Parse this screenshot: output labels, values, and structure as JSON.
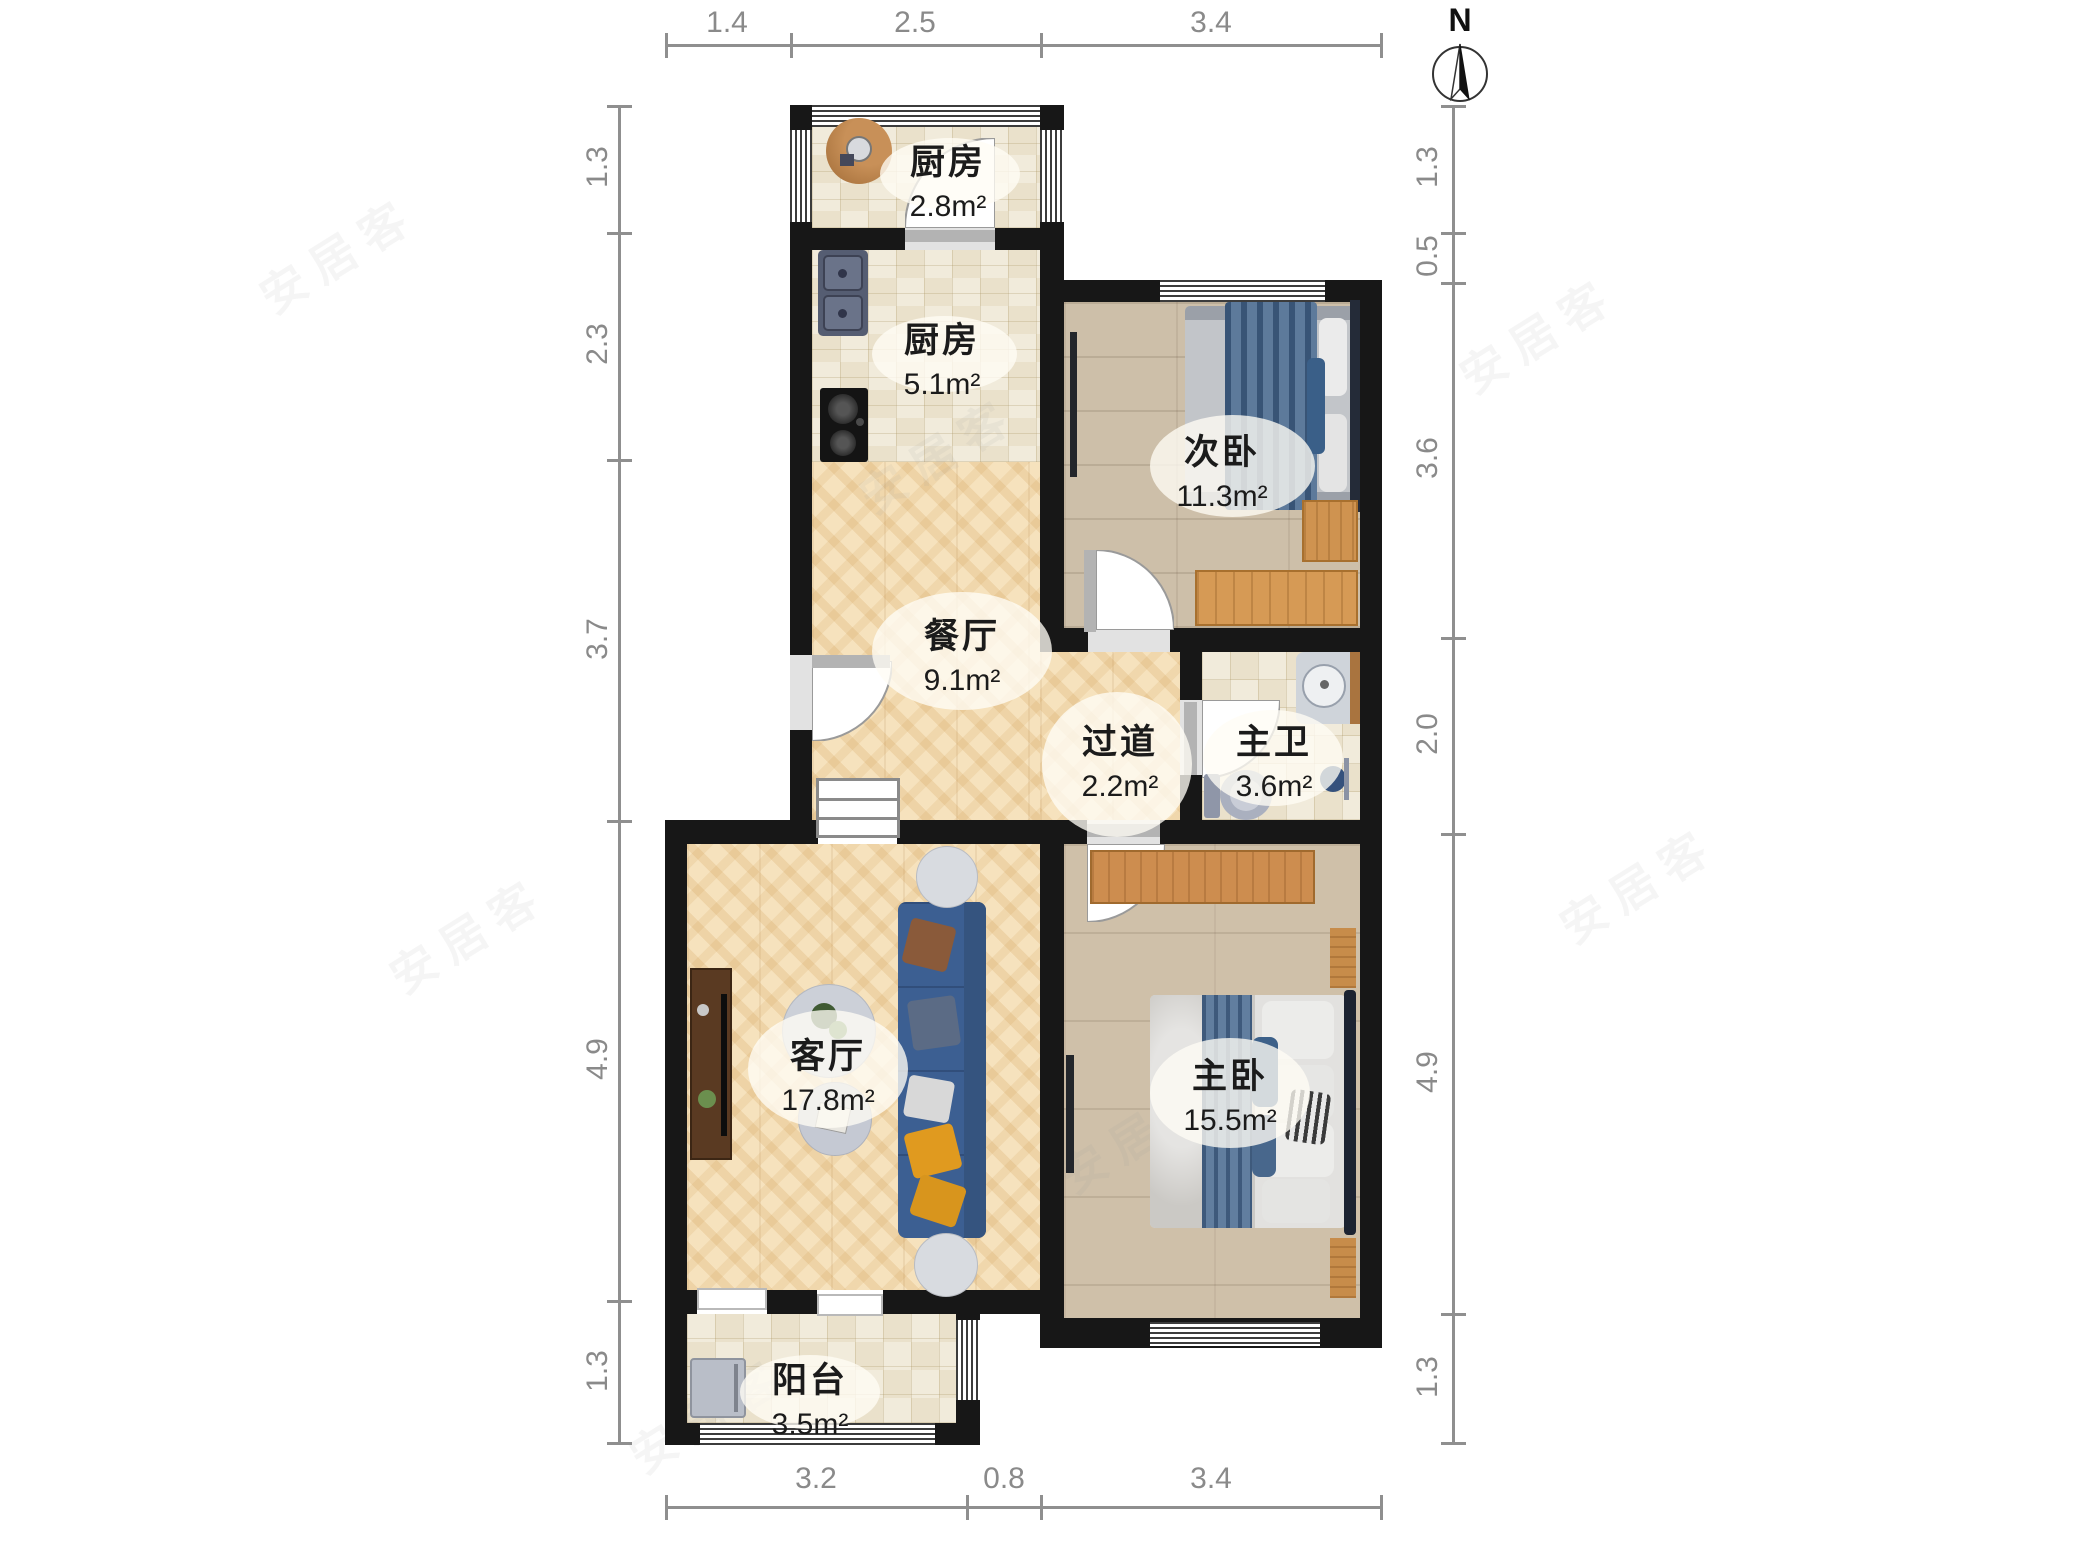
{
  "compass": {
    "label": "N"
  },
  "watermark": {
    "text": "安居客"
  },
  "dimensions": {
    "top": [
      "1.4",
      "2.5",
      "3.4"
    ],
    "bottom": [
      "3.2",
      "0.8",
      "3.4"
    ],
    "left": [
      "1.3",
      "2.3",
      "3.7",
      "4.9",
      "1.3"
    ],
    "right": [
      "1.3",
      "0.5",
      "3.6",
      "2.0",
      "4.9",
      "1.3"
    ]
  },
  "rooms": [
    {
      "id": "kitchen-balcony",
      "name": "厨房",
      "area": "2.8m²"
    },
    {
      "id": "kitchen",
      "name": "厨房",
      "area": "5.1m²"
    },
    {
      "id": "second-bedroom",
      "name": "次卧",
      "area": "11.3m²"
    },
    {
      "id": "dining-room",
      "name": "餐厅",
      "area": "9.1m²"
    },
    {
      "id": "hallway",
      "name": "过道",
      "area": "2.2m²"
    },
    {
      "id": "master-bathroom",
      "name": "主卫",
      "area": "3.6m²"
    },
    {
      "id": "living-room",
      "name": "客厅",
      "area": "17.8m²"
    },
    {
      "id": "master-bedroom",
      "name": "主卧",
      "area": "15.5m²"
    },
    {
      "id": "balcony",
      "name": "阳台",
      "area": "3.5m²"
    }
  ],
  "colors": {
    "wall": "#171717",
    "dimension": "#8f8f8f",
    "tile_floor": "#f1ebdb",
    "herringbone_floor": "#f6e2bd",
    "plank_floor": "#cdbfa9",
    "sofa_blue": "#3c5f92",
    "bed_blanket_blue": "#47688d",
    "wardrobe_orange": "#cd8d4f"
  }
}
